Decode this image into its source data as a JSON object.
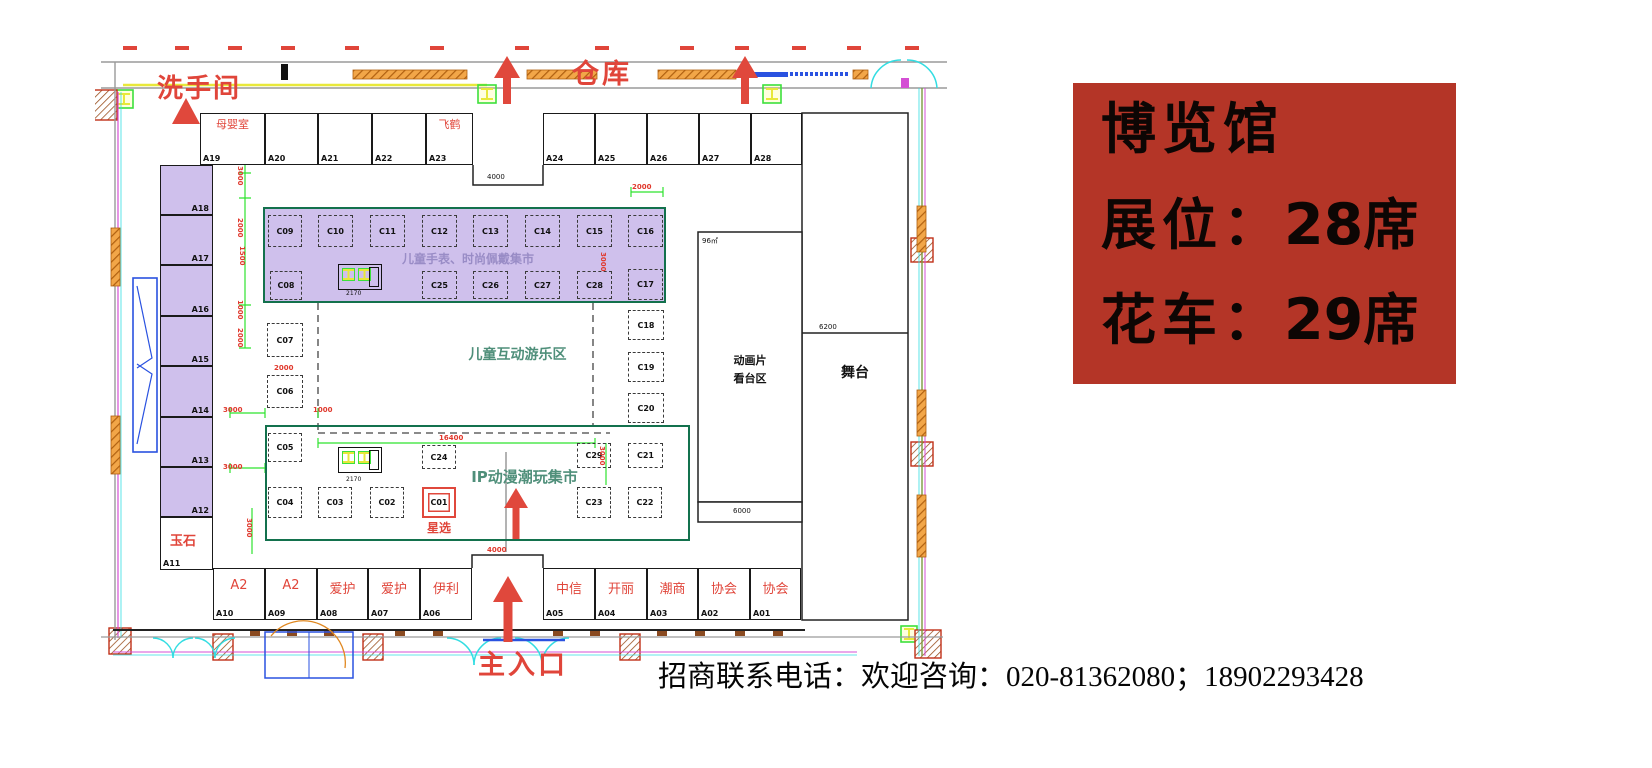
{
  "info_card": {
    "title": "博览馆",
    "rows": [
      {
        "label": "展位：",
        "value": "28",
        "unit": "席"
      },
      {
        "label": "花车：",
        "value": "29",
        "unit": "席"
      }
    ]
  },
  "contact": {
    "text": "招商联系电话：欢迎咨询：020-81362080；18902293428"
  },
  "plan": {
    "labels": {
      "restroom": "洗手间",
      "warehouse": "仓库",
      "main_entrance": "主入口",
      "stage": "舞台",
      "anim_line1": "动画片",
      "anim_line2": "看台区",
      "area_size": "96㎡",
      "nursing_room": "母婴室",
      "feihe": "飞鹤",
      "jade": "玉石",
      "star_select": "星选",
      "watch_market_title": "儿童手表、时尚佩戴集市",
      "kids_play_title": "儿童互动游乐区",
      "ip_market_title": "IP动漫潮玩集市"
    },
    "booths": {
      "top": [
        "A19",
        "A20",
        "A21",
        "A22",
        "A23",
        "A24",
        "A25",
        "A26",
        "A27",
        "A28"
      ],
      "left": [
        "A18",
        "A17",
        "A16",
        "A15",
        "A14",
        "A13",
        "A12",
        "A11"
      ],
      "watch_row1": [
        "C09",
        "C10",
        "C11",
        "C12",
        "C13",
        "C14",
        "C15",
        "C16"
      ],
      "watch_row2": [
        "C08",
        "C25",
        "C26",
        "C27",
        "C28",
        "C17"
      ],
      "play_left": [
        "C07",
        "C06"
      ],
      "play_right": [
        "C18",
        "C19",
        "C20"
      ],
      "market": [
        "C05",
        "C24",
        "C29",
        "C21",
        "C04",
        "C03",
        "C02",
        "C01",
        "C23",
        "C22"
      ],
      "bottom": [
        {
          "id": "A10",
          "tenant": "A2"
        },
        {
          "id": "A09",
          "tenant": "A2"
        },
        {
          "id": "A08",
          "tenant": "爱护"
        },
        {
          "id": "A07",
          "tenant": "爱护"
        },
        {
          "id": "A06",
          "tenant": "伊利"
        },
        {
          "id": "A05",
          "tenant": "中信"
        },
        {
          "id": "A04",
          "tenant": "开丽"
        },
        {
          "id": "A03",
          "tenant": "潮商"
        },
        {
          "id": "A02",
          "tenant": "协会"
        },
        {
          "id": "A01",
          "tenant": "协会"
        }
      ]
    },
    "dims": {
      "d4000": "4000",
      "d3000": "3000",
      "d2000": "2000",
      "d1500": "1500",
      "d1000": "1000",
      "d16400": "16400",
      "d6000": "6000",
      "d6200": "6200",
      "d2170": "2170"
    },
    "colors": {
      "accent_red": "#e0453a",
      "zone_green": "#13714d",
      "purple_fill": "#cfc0ec",
      "teal_text": "#4f8f7a",
      "card_red": "#b43527"
    }
  }
}
